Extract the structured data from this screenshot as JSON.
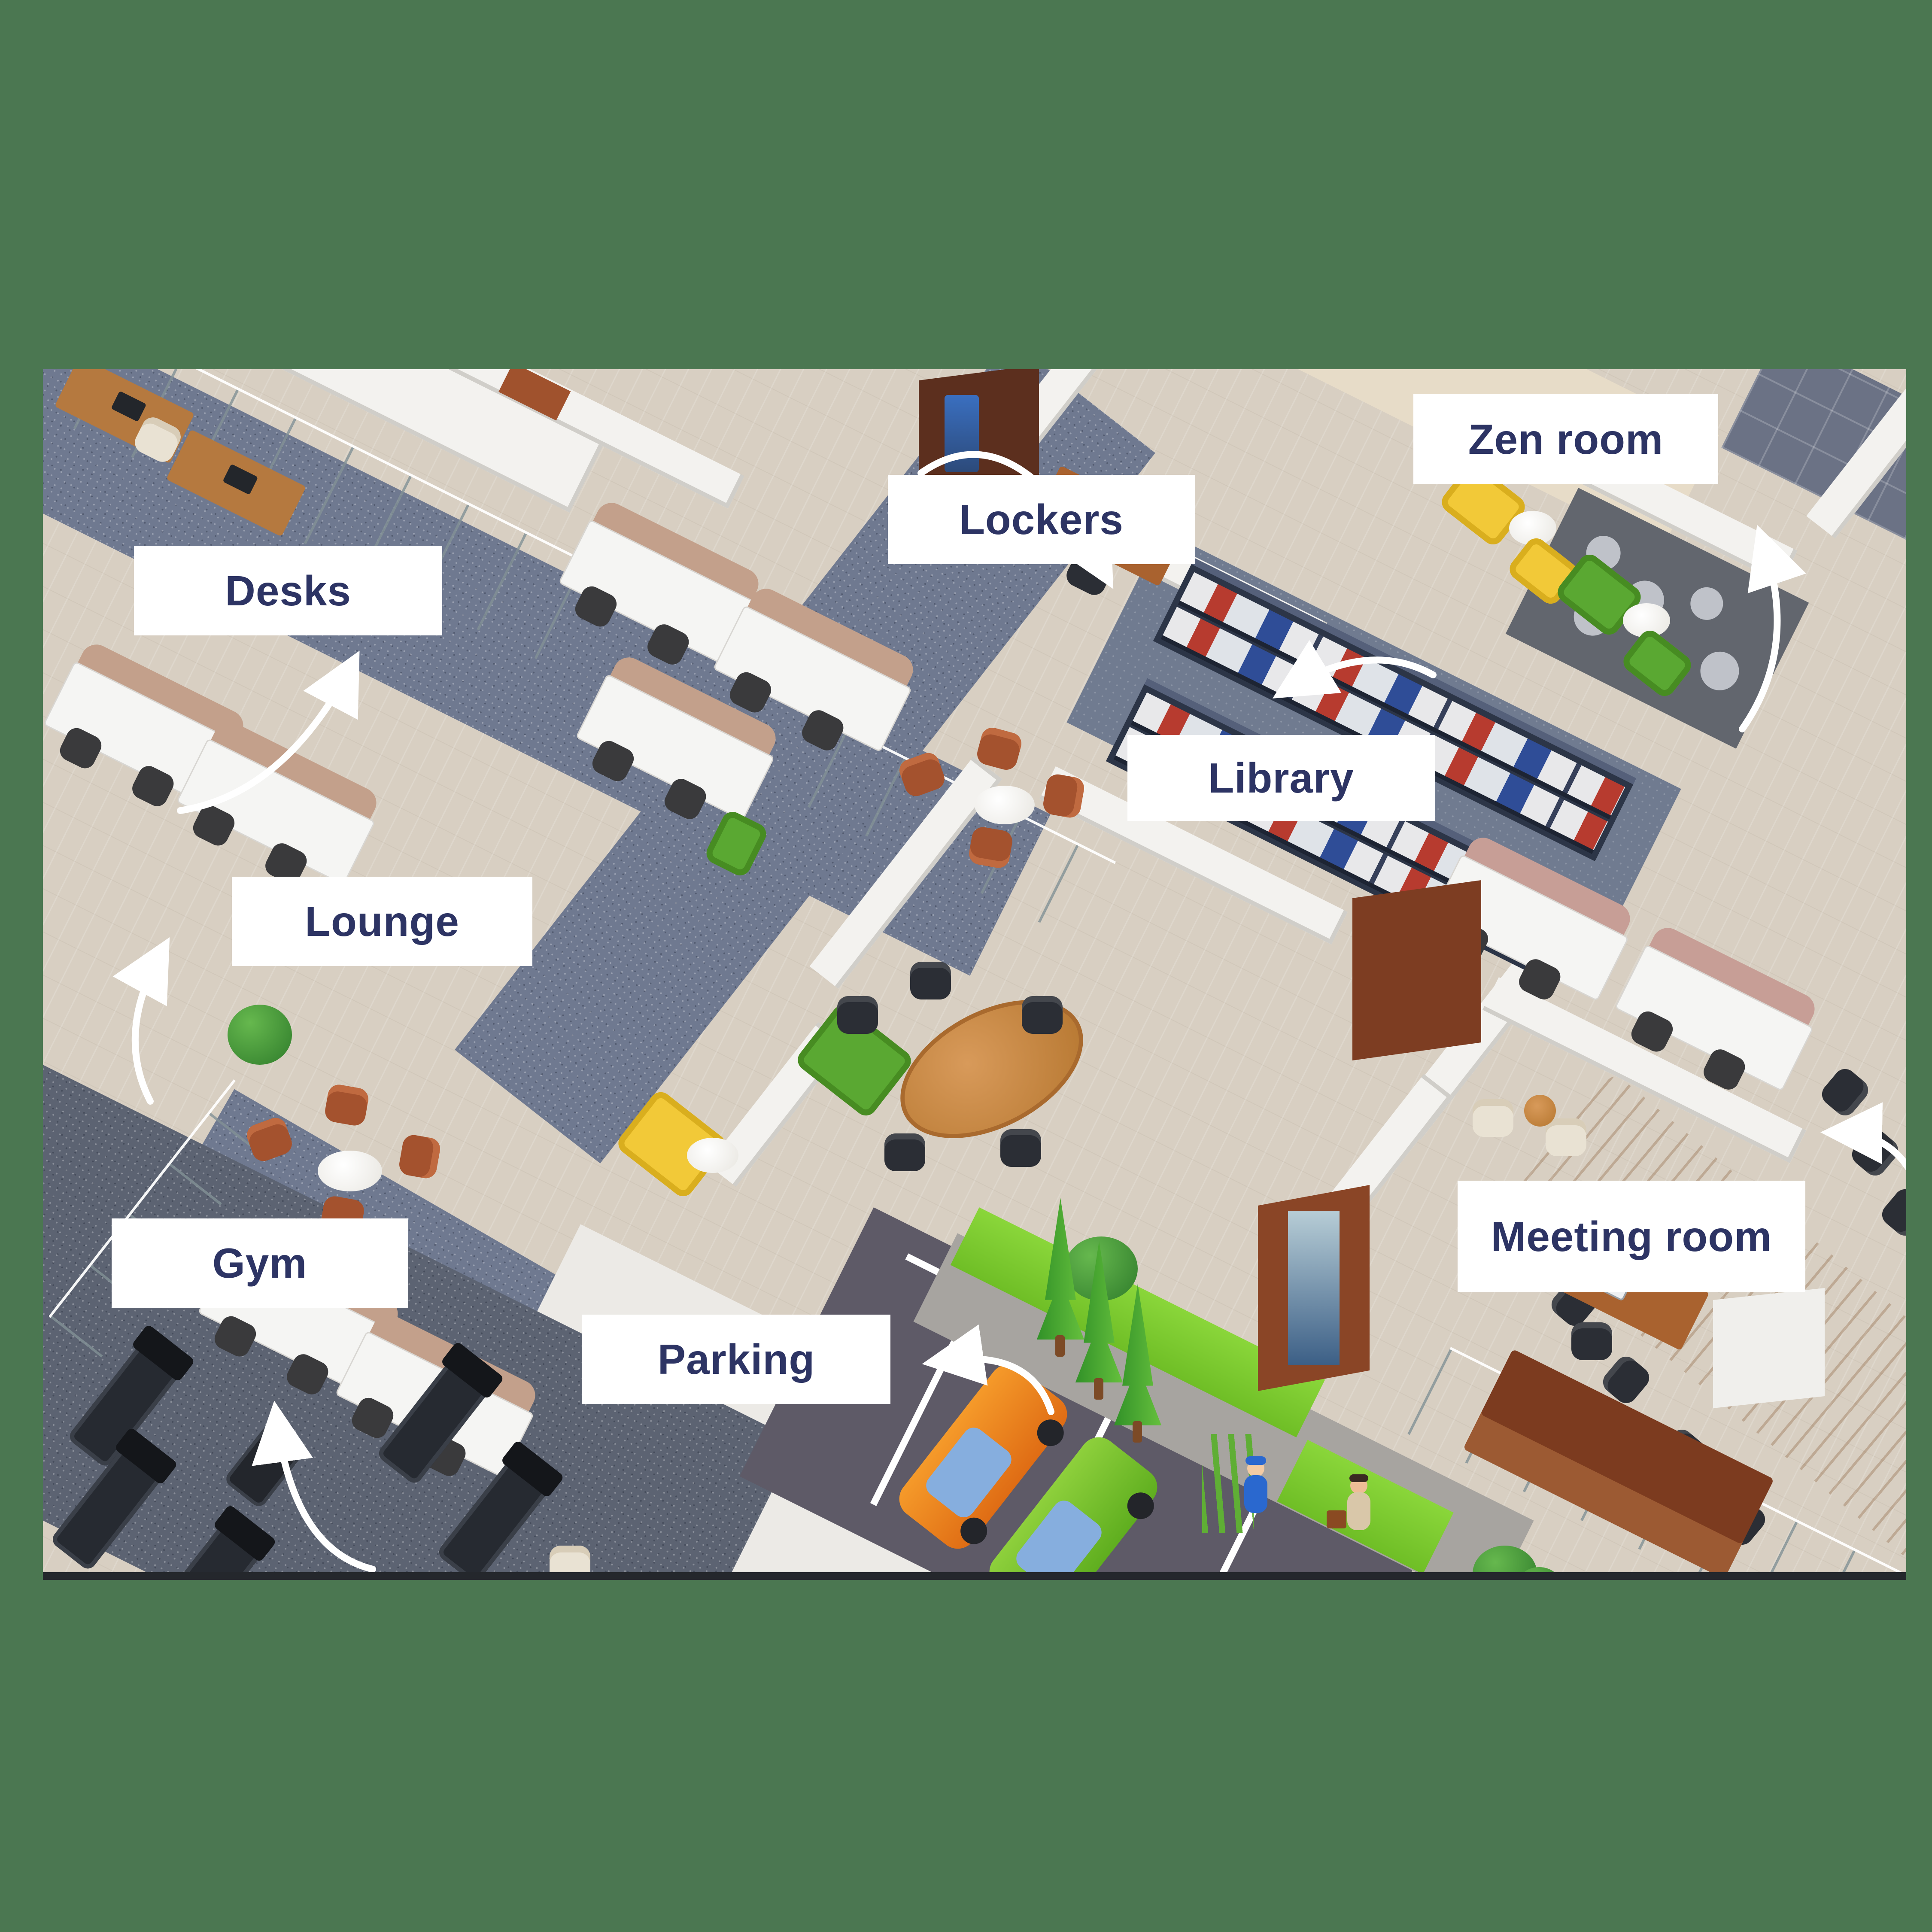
{
  "illustration": {
    "description": "Isometric 3D office floor plan with annotated areas",
    "background_color": "#4b7751",
    "label_background": "#ffffff",
    "label_text_color": "#2d3464",
    "arrow_color": "#ffffff"
  },
  "labels": {
    "desks": "Desks",
    "lockers": "Lockers",
    "zen_room": "Zen room",
    "library": "Library",
    "lounge": "Lounge",
    "meeting_room": "Meeting room",
    "gym": "Gym",
    "parking": "Parking"
  },
  "areas": [
    {
      "name": "desks",
      "features": "open space white workstations with beige privacy screens"
    },
    {
      "name": "lockers",
      "features": "wooden wardrobe cabinet and reception desk"
    },
    {
      "name": "zen_room",
      "features": "yellow and green acoustic booths, pebble stone floor"
    },
    {
      "name": "library",
      "features": "dark metal shelving with red, white and blue binders"
    },
    {
      "name": "lounge",
      "features": "four rust armchairs around a round white table"
    },
    {
      "name": "meeting_room",
      "features": "long wooden conference table with black chairs"
    },
    {
      "name": "gym",
      "features": "treadmills and exercise bike on dark carpet"
    },
    {
      "name": "parking",
      "features": "orange and green cars, sidewalk, lawn, cypress trees, security guard and visitor"
    }
  ]
}
